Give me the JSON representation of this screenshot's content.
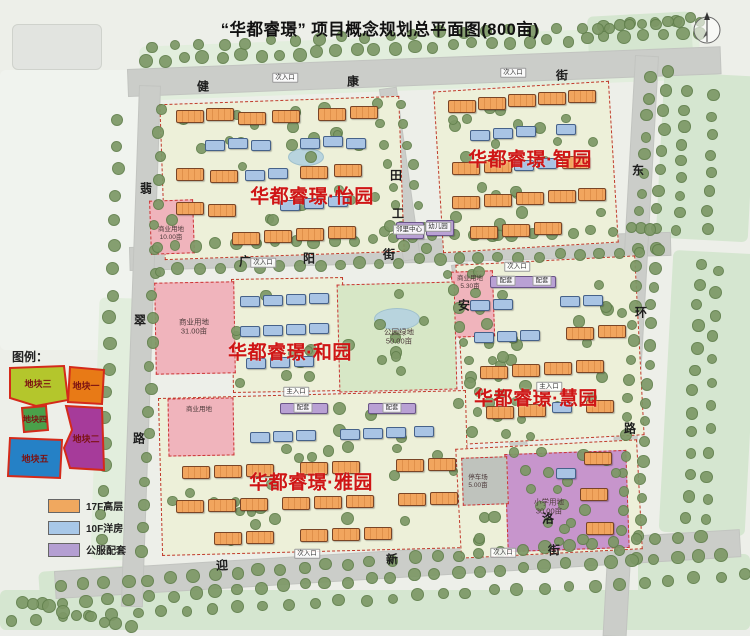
{
  "title": "“华都睿璟” 项目概念规划总平面图(800亩)",
  "districts": [
    {
      "name": "华都睿璟·怡园"
    },
    {
      "name": "华都睿璟·智园"
    },
    {
      "name": "华都睿璟·和园"
    },
    {
      "name": "华都睿璟·慧园"
    },
    {
      "name": "华都睿璟·雅园"
    }
  ],
  "roads": {
    "jiankang": {
      "name": "健康街",
      "chars": [
        "健",
        "康",
        "街"
      ]
    },
    "guangyang": {
      "name": "广阳街",
      "chars": [
        "广",
        "阳",
        "街"
      ]
    },
    "yingxin": {
      "name": "迎新街",
      "chars": [
        "迎",
        "新",
        "街"
      ]
    },
    "feicui": {
      "name": "翡翠路",
      "chars": [
        "翡",
        "翠",
        "路"
      ]
    },
    "donghuan": {
      "name": "东环路",
      "chars": [
        "东",
        "环",
        "路"
      ]
    },
    "middle": {
      "chars": [
        "田",
        "工",
        "安",
        "洛"
      ]
    }
  },
  "land_use": [
    {
      "label": "商业用地",
      "area": "10.00亩"
    },
    {
      "label": "商业用地",
      "area": "31.00亩"
    },
    {
      "label": "公园绿地",
      "area": "50.00亩"
    },
    {
      "label": "商业用地",
      "area": "5.30亩"
    },
    {
      "label": "停车场",
      "area": "5.00亩"
    },
    {
      "label": "小学用地",
      "area": "30.00亩"
    },
    {
      "label": "商业用地",
      "area": ""
    }
  ],
  "facilities": {
    "neighborhood_center": "邻里中心",
    "kindergarten": "幼儿园",
    "support": "配套"
  },
  "entrances": {
    "secondary": "次入口",
    "main": "主入口"
  },
  "legend": {
    "title": "图例：",
    "parcels": [
      {
        "label": "地块三",
        "color": "#b4c62c"
      },
      {
        "label": "地块一",
        "color": "#e87a16"
      },
      {
        "label": "地块四",
        "color": "#4aa04a"
      },
      {
        "label": "地块二",
        "color": "#a63b9a"
      },
      {
        "label": "地块五",
        "color": "#2581c6"
      }
    ],
    "building_types": [
      {
        "label": "17F高层",
        "color": "#f0a85f"
      },
      {
        "label": "10F洋房",
        "color": "#a8c8e8"
      },
      {
        "label": "公服配套",
        "color": "#b49fd2"
      }
    ]
  },
  "colors": {
    "district_label": "#cf1515",
    "road": "#cbcdc9",
    "plot": "#edf0d9",
    "park": "#d7e7c6",
    "commercial": "#f0b4bc",
    "school": "#c795cc"
  }
}
